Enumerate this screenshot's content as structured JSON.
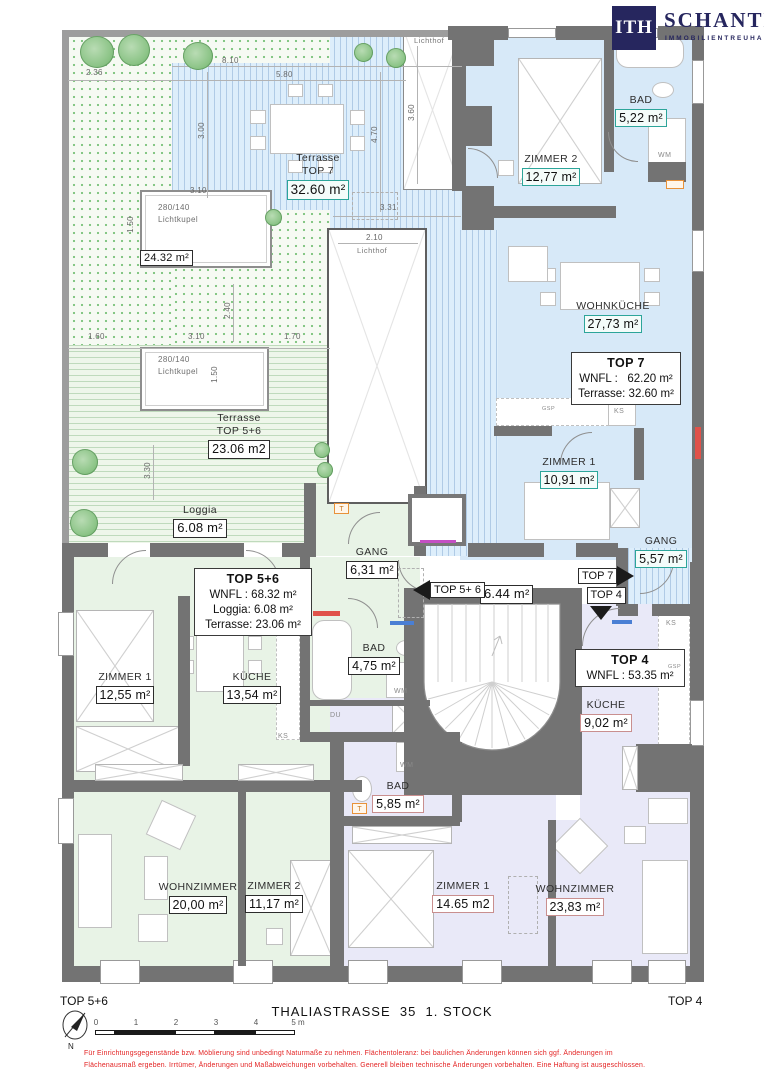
{
  "brand": {
    "mark": "ITH",
    "name": "SCHANTL",
    "sub": "IMMOBILIENTREUHAND"
  },
  "units": {
    "top7": {
      "title": "TOP 7",
      "wnfl": "WNFL :   62.20 m²",
      "terrasse": "Terrasse: 32.60 m²"
    },
    "top56": {
      "title": "TOP 5+6",
      "wnfl": "WNFL : 68.32 m²",
      "loggia": "Loggia: 6.08 m²",
      "terrasse": "Terrasse: 23.06 m²"
    },
    "top4": {
      "title": "TOP 4",
      "wnfl": "WNFL : 53.35 m²"
    }
  },
  "rooms": {
    "terrasse7": {
      "name": "Terrasse",
      "sub": "TOP 7",
      "area": "32.60 m²"
    },
    "bad7": {
      "name": "BAD",
      "area": "5,22 m²"
    },
    "zimmer2_7": {
      "name": "ZIMMER 2",
      "area": "12,77 m²"
    },
    "wohnkueche7": {
      "name": "WOHNKÜCHE",
      "area": "27,73 m²"
    },
    "zimmer1_7": {
      "name": "ZIMMER 1",
      "area": "10,91 m²"
    },
    "gang7": {
      "name": "GANG",
      "area": "5,57 m²"
    },
    "terrasse56": {
      "name": "Terrasse",
      "sub": "TOP 5+6",
      "area": "23.06 m2"
    },
    "loggia": {
      "name": "Loggia",
      "area": "6.08 m²"
    },
    "gang56": {
      "name": "GANG",
      "area": "6,31 m²"
    },
    "zimmer1_56": {
      "name": "ZIMMER 1",
      "area": "12,55 m²"
    },
    "kueche56": {
      "name": "KÜCHE",
      "area": "13,54 m²"
    },
    "bad56": {
      "name": "BAD",
      "area": "4,75 m²"
    },
    "wohnzimmer56": {
      "name": "WOHNZIMMER",
      "area": "20,00 m²"
    },
    "zimmer2_56": {
      "name": "ZIMMER 2",
      "area": "11,17 m²"
    },
    "kueche4": {
      "name": "KÜCHE",
      "area": "9,02 m²"
    },
    "bad4": {
      "name": "BAD",
      "area": "5,85 m²"
    },
    "zimmer1_4": {
      "name": "ZIMMER 1",
      "area": "14.65 m2"
    },
    "wohnzimmer4": {
      "name": "WOHNZIMMER",
      "area": "23,83 m²"
    },
    "stiegenhaus": {
      "area": "6.44 m²"
    }
  },
  "features": {
    "lichthof_top": "Lichthof",
    "lichthof_mid_dim": "2.10",
    "lichthof_mid": "Lichthof",
    "kupel_size": "280/140",
    "kupel_label": "Lichtkupel",
    "kupel_area": "24.32 m²"
  },
  "nav": {
    "to_top56": "TOP 5+ 6",
    "to_top7": "TOP 7",
    "to_top4": "TOP 4"
  },
  "small": {
    "wm": "WM",
    "du": "DU",
    "ks": "KS",
    "gsp": "GSP",
    "t": "T"
  },
  "dims": {
    "d236": "2.36",
    "d810": "8.10",
    "d580": "5.80",
    "d300": "3.00",
    "d470": "4.70",
    "d360": "3.60",
    "d331": "3.31",
    "d310a": "3.10",
    "d150a": "1.50",
    "d240": "2.40",
    "d160": "1.60",
    "d310b": "3.10",
    "d170": "1.70",
    "d150b": "1.50",
    "d330": "3.30"
  },
  "footer": {
    "left": "TOP 5+6",
    "right": "TOP 4",
    "title": "THALIASTRASSE  35  1. STOCK",
    "north": "N",
    "scale": [
      "0",
      "1",
      "2",
      "3",
      "4",
      "5 m"
    ],
    "disclaimer": "Für Einrichtungsgegenstände bzw. Möblierung sind unbedingt Naturmaße zu nehmen.  Flächentoleranz: bei baulichen Änderungen können sich ggf. Änderungen im\nFlächenausmaß ergeben. Irrtümer, Änderungen und Maßabweichungen vorbehalten. Generell bleiben technische Änderungen vorbehalten. Eine Haftung ist ausgeschlossen."
  }
}
